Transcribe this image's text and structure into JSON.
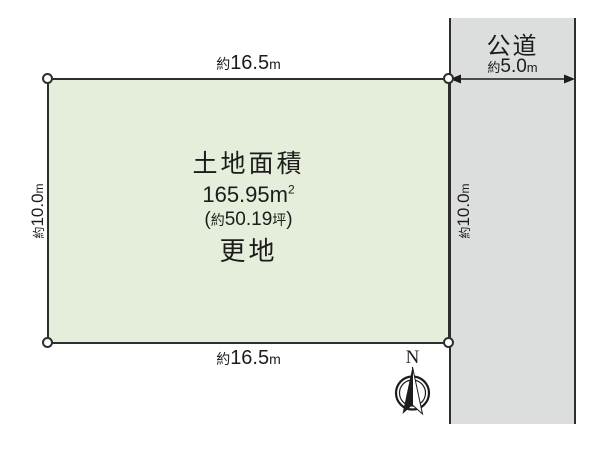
{
  "plot": {
    "fill_color": "#e4eeda",
    "area_label": "土地面積",
    "area_m2": {
      "number": "165.95",
      "unit": "m",
      "sup": "2"
    },
    "area_tsubo": {
      "paren_open": "(",
      "prefix": "約",
      "value": "50.19",
      "unit": "坪",
      "paren_close": ")"
    },
    "status": "更地"
  },
  "road": {
    "name": "公道",
    "fill_color": "#dcdddd",
    "width": {
      "prefix": "約",
      "value": "5.0",
      "unit": "m"
    }
  },
  "dimensions": {
    "top": {
      "prefix": "約",
      "value": "16.5",
      "unit": "m"
    },
    "bottom": {
      "prefix": "約",
      "value": "16.5",
      "unit": "m"
    },
    "left": {
      "prefix": "約",
      "value": "10.0",
      "unit": "m"
    },
    "right": {
      "prefix": "約",
      "value": "10.0",
      "unit": "m"
    }
  },
  "compass": {
    "north_label": "N"
  },
  "colors": {
    "line": "#2e2e2e",
    "text": "#1c1c1c"
  }
}
